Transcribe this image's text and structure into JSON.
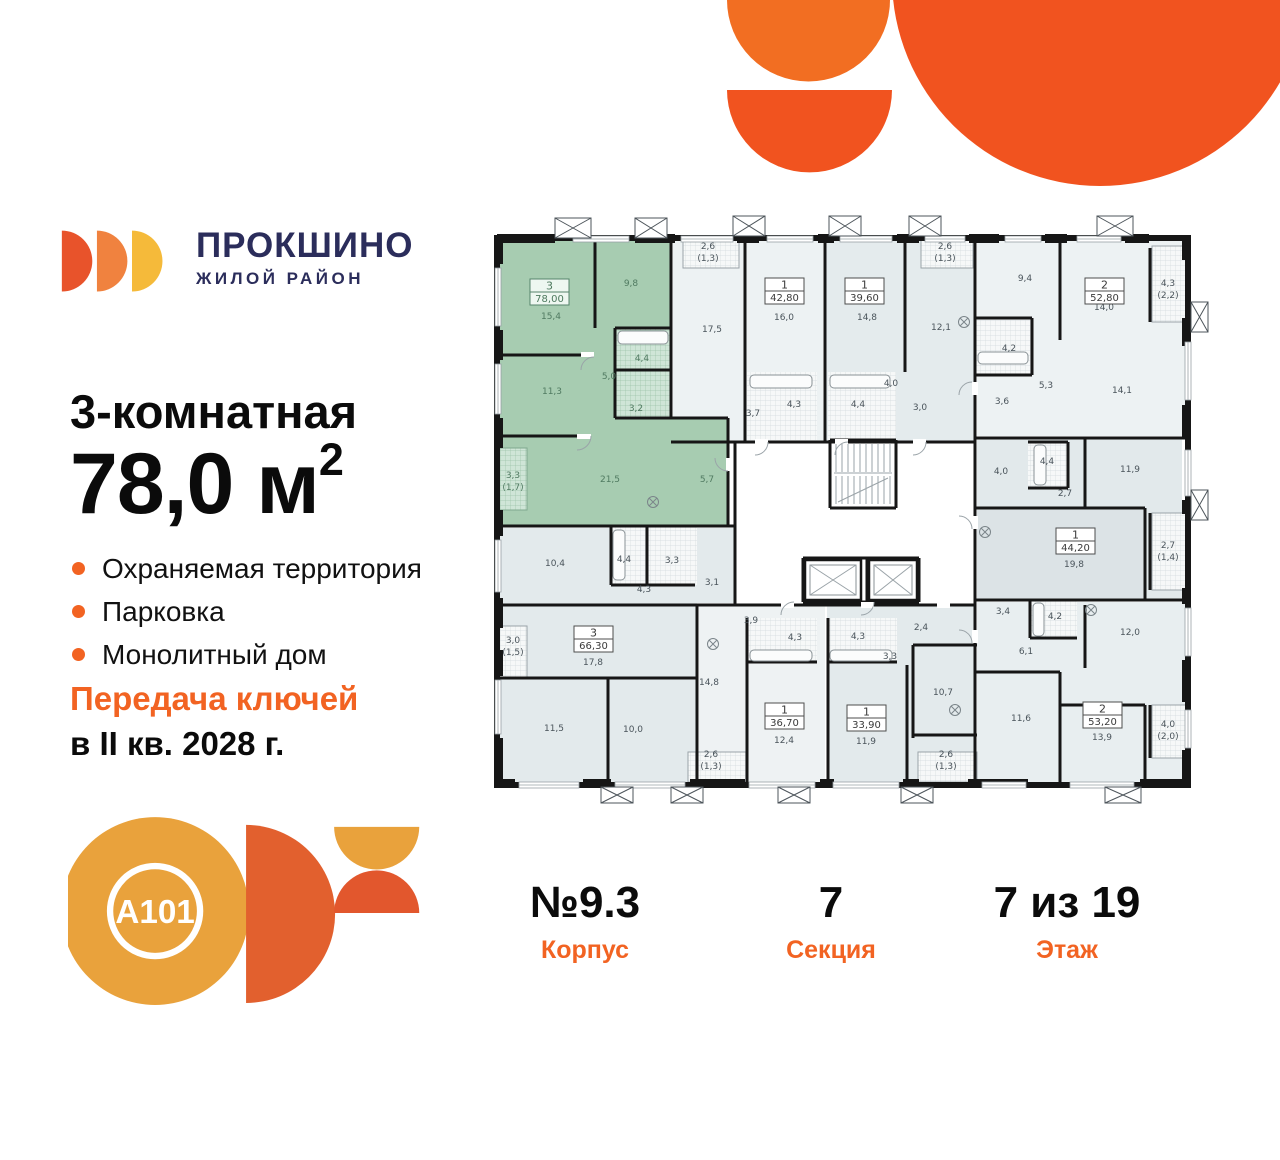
{
  "brand": {
    "name": "ПРОКШИНО",
    "subtitle": "ЖИЛОЙ РАЙОН"
  },
  "listing": {
    "title": "3-комнатная",
    "area_value": "78,0",
    "area_unit": "м",
    "area_sup": "2",
    "features": [
      "Охраняемая территория",
      "Парковка",
      "Монолитный дом"
    ],
    "keys_line1": "Передача ключей",
    "keys_line2": "в II кв. 2028 г."
  },
  "developer": {
    "logo_text": "A101"
  },
  "stats": [
    {
      "value": "№9.3",
      "label": "Корпус"
    },
    {
      "value": "7",
      "label": "Секция"
    },
    {
      "value": "7 из 19",
      "label": "Этаж"
    }
  ],
  "colors": {
    "accent": "#F26322",
    "decor_orange": "#F1531F",
    "decor_orange_light": "#F26E22",
    "navy": "#2B2D5B",
    "selected_green": "#A7CCB1",
    "a101_gold": "#E9A23C",
    "a101_orange": "#E2602E",
    "logo_shapes": [
      "#E8532B",
      "#F0823F",
      "#F5BA3A"
    ]
  },
  "plan": {
    "units": [
      {
        "name": "apartment-78-00-selected",
        "rooms": "3",
        "area": "78,00",
        "highlighted": true,
        "box": [
          45,
          69
        ],
        "labels": [
          [
            "15,4",
            66,
            109
          ],
          [
            "9,8",
            146,
            76
          ],
          [
            "11,3",
            67,
            184
          ],
          [
            "4,4",
            157,
            151
          ],
          [
            "5,0",
            124,
            169
          ],
          [
            "3,2",
            151,
            201
          ],
          [
            "21,5",
            125,
            272
          ],
          [
            "5,7",
            222,
            272
          ],
          [
            "3,3",
            28,
            268
          ],
          [
            "(1,7)",
            28,
            280
          ]
        ]
      },
      {
        "name": "apartment-42-80",
        "rooms": "1",
        "area": "42,80",
        "highlighted": false,
        "box": [
          280,
          68
        ],
        "labels": [
          [
            "2,6",
            223,
            39
          ],
          [
            "(1,3)",
            223,
            51
          ],
          [
            "17,5",
            227,
            122
          ],
          [
            "16,0",
            299,
            110
          ],
          [
            "4,3",
            309,
            197
          ],
          [
            "3,7",
            268,
            206
          ]
        ]
      },
      {
        "name": "apartment-39-60",
        "rooms": "1",
        "area": "39,60",
        "highlighted": false,
        "box": [
          360,
          68
        ],
        "labels": [
          [
            "2,6",
            460,
            39
          ],
          [
            "(1,3)",
            460,
            51
          ],
          [
            "14,8",
            382,
            110
          ],
          [
            "12,1",
            456,
            120
          ],
          [
            "4,4",
            373,
            197
          ],
          [
            "4,0",
            406,
            176
          ],
          [
            "3,0",
            435,
            200
          ]
        ]
      },
      {
        "name": "apartment-52-80",
        "rooms": "2",
        "area": "52,80",
        "highlighted": false,
        "box": [
          600,
          68
        ],
        "labels": [
          [
            "9,4",
            540,
            71
          ],
          [
            "14,0",
            619,
            100
          ],
          [
            "4,2",
            524,
            141
          ],
          [
            "5,3",
            561,
            178
          ],
          [
            "3,6",
            517,
            194
          ],
          [
            "14,1",
            637,
            183
          ],
          [
            "4,3",
            683,
            76
          ],
          [
            "(2,2)",
            683,
            88
          ]
        ]
      },
      {
        "name": "apartment-44-20",
        "rooms": "1",
        "area": "44,20",
        "highlighted": false,
        "box": [
          571,
          318
        ],
        "labels": [
          [
            "4,0",
            516,
            264
          ],
          [
            "4,4",
            562,
            254
          ],
          [
            "2,7",
            580,
            286
          ],
          [
            "11,9",
            645,
            262
          ],
          [
            "19,8",
            589,
            357
          ],
          [
            "2,7",
            683,
            338
          ],
          [
            "(1,4)",
            683,
            350
          ]
        ]
      },
      {
        "name": "apartment-53-20",
        "rooms": "2",
        "area": "53,20",
        "highlighted": false,
        "box": [
          598,
          492
        ],
        "labels": [
          [
            "3,4",
            518,
            404
          ],
          [
            "4,2",
            570,
            409
          ],
          [
            "12,0",
            645,
            425
          ],
          [
            "6,1",
            541,
            444
          ],
          [
            "11,6",
            536,
            511
          ],
          [
            "13,9",
            617,
            530
          ],
          [
            "4,0",
            683,
            517
          ],
          [
            "(2,0)",
            683,
            529
          ]
        ]
      },
      {
        "name": "apartment-66-30",
        "rooms": "3",
        "area": "66,30",
        "highlighted": false,
        "box": [
          89,
          416
        ],
        "labels": [
          [
            "10,4",
            70,
            356
          ],
          [
            "4,4",
            139,
            352
          ],
          [
            "3,3",
            187,
            353
          ],
          [
            "4,3",
            159,
            382
          ],
          [
            "3,1",
            227,
            375
          ],
          [
            "17,8",
            108,
            455
          ],
          [
            "11,5",
            69,
            521
          ],
          [
            "10,0",
            148,
            522
          ],
          [
            "3,0",
            28,
            433
          ],
          [
            "(1,5)",
            28,
            445
          ]
        ]
      },
      {
        "name": "apartment-36-70",
        "rooms": "1",
        "area": "36,70",
        "highlighted": false,
        "box": [
          280,
          493
        ],
        "labels": [
          [
            "3,9",
            266,
            413
          ],
          [
            "4,3",
            310,
            430
          ],
          [
            "14,8",
            224,
            475
          ],
          [
            "12,4",
            299,
            533
          ],
          [
            "2,6",
            226,
            547
          ],
          [
            "(1,3)",
            226,
            559
          ]
        ]
      },
      {
        "name": "apartment-33-90",
        "rooms": "1",
        "area": "33,90",
        "highlighted": false,
        "box": [
          362,
          495
        ],
        "labels": [
          [
            "4,3",
            373,
            429
          ],
          [
            "3,3",
            405,
            449
          ],
          [
            "2,4",
            436,
            420
          ],
          [
            "10,7",
            458,
            485
          ],
          [
            "11,9",
            381,
            534
          ],
          [
            "2,6",
            461,
            547
          ],
          [
            "(1,3)",
            461,
            559
          ]
        ]
      }
    ]
  }
}
